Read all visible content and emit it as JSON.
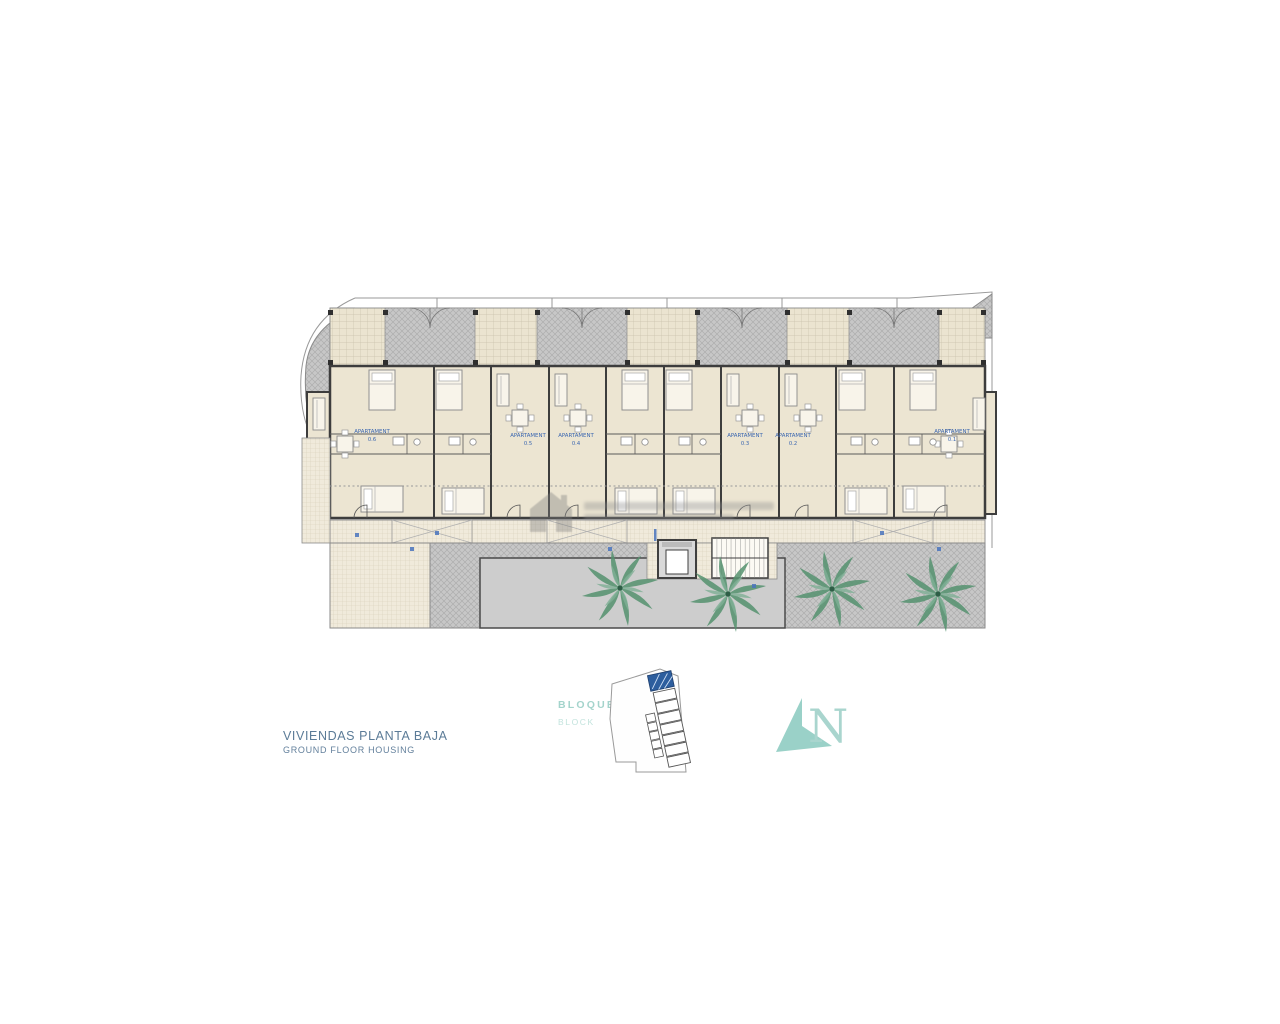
{
  "title": {
    "line1": "VIVIENDAS PLANTA BAJA",
    "line2": "GROUND FLOOR HOUSING"
  },
  "block": {
    "label_es": "BLOQUE",
    "number": "2",
    "label_en": "BLOCK"
  },
  "north": {
    "letter": "N"
  },
  "plan": {
    "apartments": [
      {
        "name": "APARTAMENT",
        "number": "0.6"
      },
      {
        "name": "APARTAMENT",
        "number": "0.5"
      },
      {
        "name": "APARTAMENT",
        "number": "0.4"
      },
      {
        "name": "APARTAMENT",
        "number": "0.3"
      },
      {
        "name": "APARTAMENT",
        "number": "0.2"
      },
      {
        "name": "APARTAMENT",
        "number": "0.1"
      }
    ]
  },
  "colors": {
    "accent_teal": "#8fcdc4",
    "apartment_label_blue": "#3a66b0",
    "title_blue": "#5b7b97",
    "wall_dark": "#3d3d3d",
    "floor_cream": "#ece5d2",
    "terrace_gray": "#c7c7c7",
    "palm_green": "#55926f",
    "site_highlight_blue": "#2d5e9e"
  }
}
